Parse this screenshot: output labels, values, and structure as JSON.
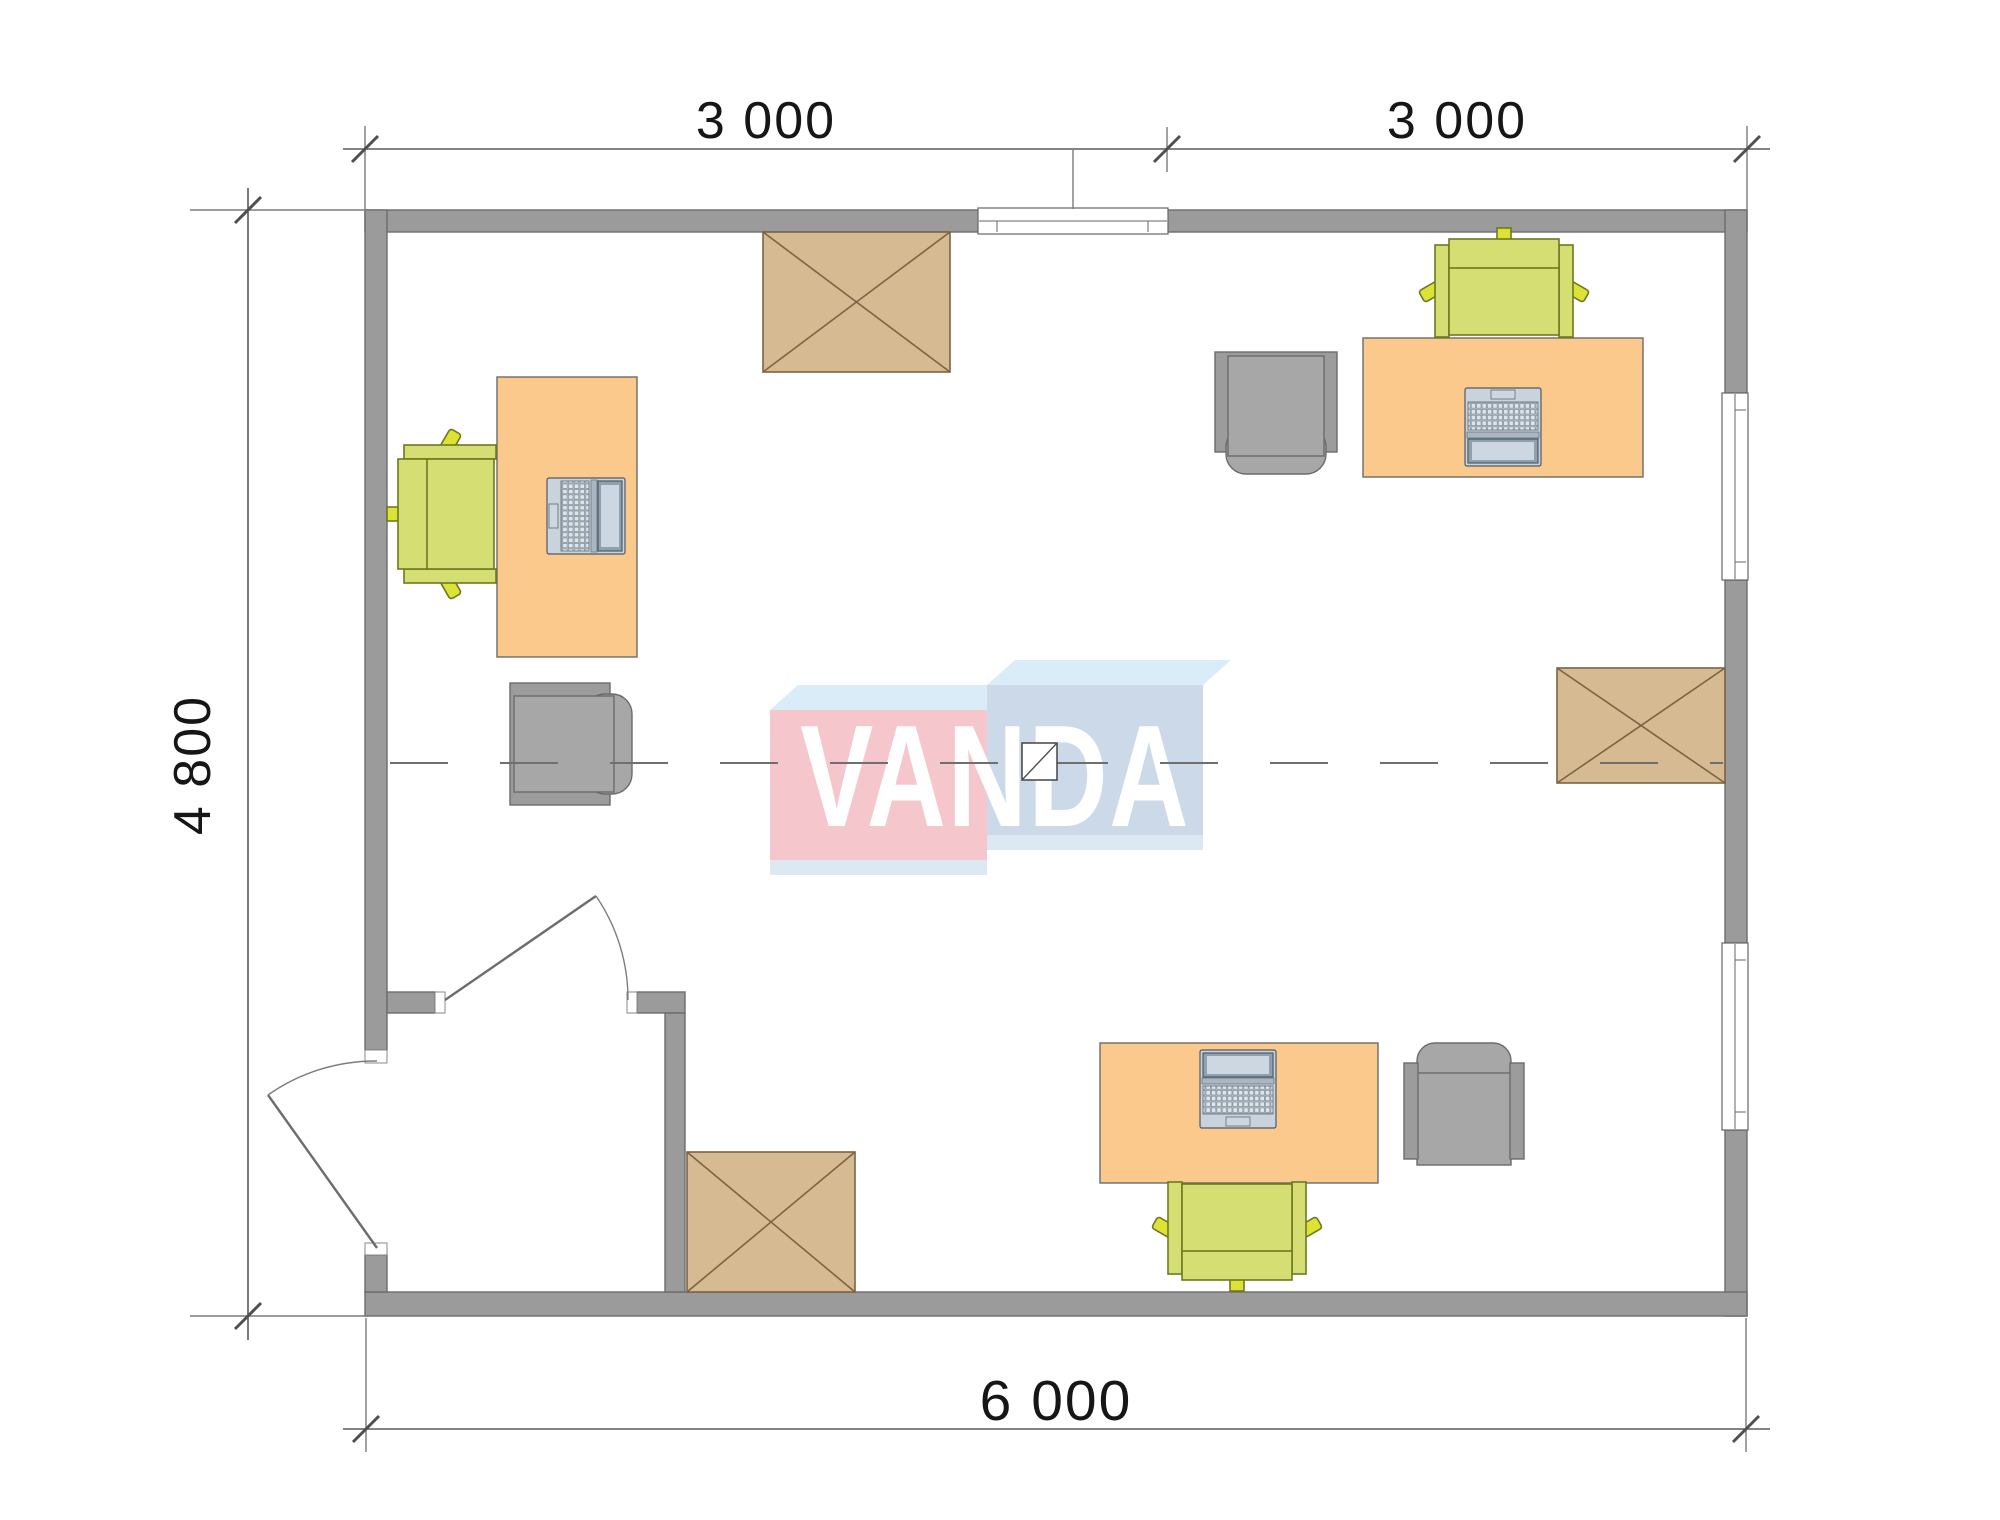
{
  "dimensions": {
    "top_left": "3 000",
    "top_right": "3 000",
    "left": "4 800",
    "bottom": "6 000"
  },
  "watermark": {
    "text": "VANDA"
  },
  "plan": {
    "colors": {
      "wall": "#9b9b9b",
      "white": "#ffffff",
      "desk": "#fbc98b",
      "chair": "#d5de72",
      "chairnub": "#dde334",
      "cabinet": "#d6ba92",
      "grayseat": "#a7a7a7",
      "graybase": "#9c9c9c",
      "lapbody": "#c9d3dd",
      "lapbezel": "#8fa0ae",
      "lapscreen": "#ccd7e1",
      "lapkeys": "#dde4ea",
      "laphinge": "#aab7c2",
      "pink": "#f6c6cd",
      "blue": "#cbd9e9",
      "ltop": "#d9ecf7",
      "lshadow": "#dde9f2"
    },
    "furniture": [
      {
        "type": "office-desk",
        "count": 3
      },
      {
        "type": "laptop",
        "count": 3
      },
      {
        "type": "desk-chair-green",
        "count": 3
      },
      {
        "type": "task-chair-gray",
        "count": 2
      },
      {
        "type": "armchair-gray",
        "count": 1
      },
      {
        "type": "crossed-cabinet",
        "count": 3
      }
    ],
    "features": [
      "exterior-walls",
      "entrance-vestibule",
      "entrance-door",
      "interior-door",
      "window-top",
      "window-right-upper",
      "window-right-lower",
      "axis-centerline",
      "module-joint-marker"
    ]
  }
}
